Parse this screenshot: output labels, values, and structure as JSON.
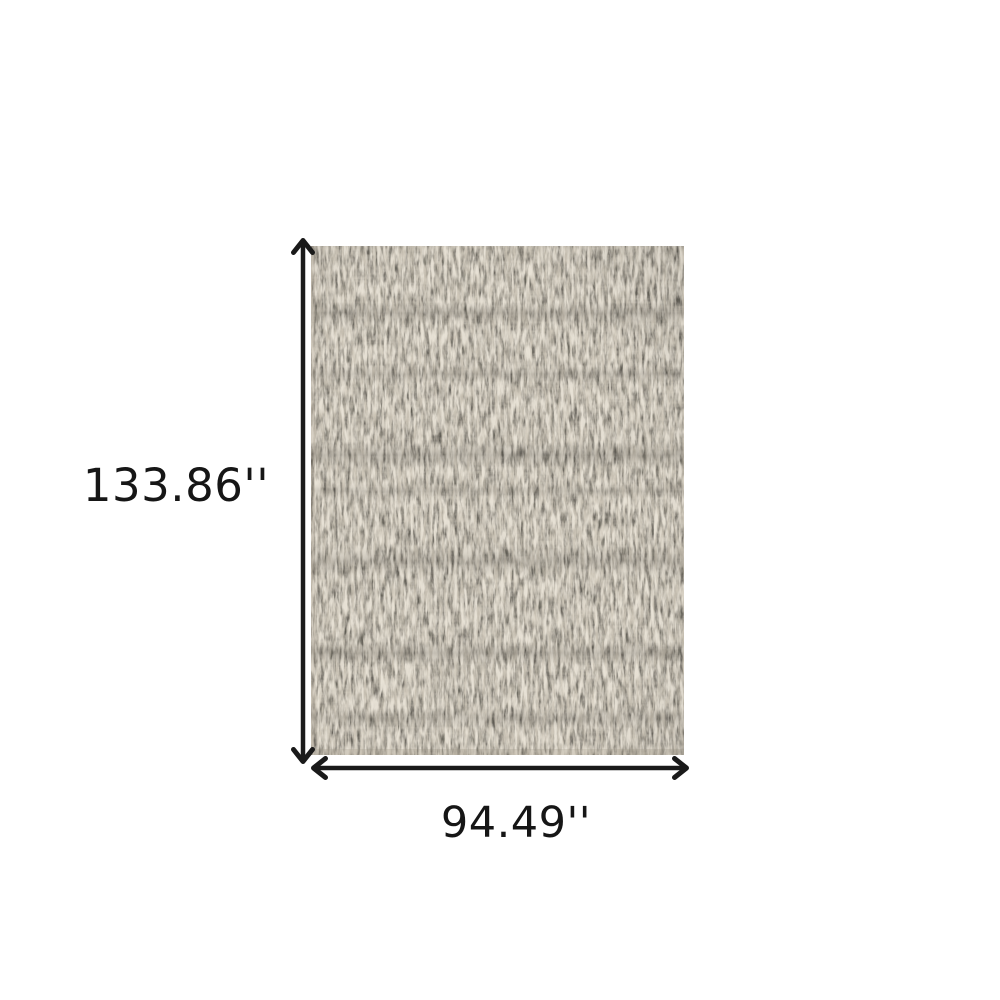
{
  "diagram": {
    "kind": "rug-dimension-diagram",
    "height_label": "133.86''",
    "width_label": "94.49''",
    "colors": {
      "background": "#ffffff",
      "arrow": "#1a1a1a",
      "label_text": "#161616",
      "rug_base": "#6b6459",
      "rug_dark_band": "#37332c",
      "rug_cream_speck": "#d8d0c1",
      "rug_white_speck": "#ece6da"
    }
  }
}
